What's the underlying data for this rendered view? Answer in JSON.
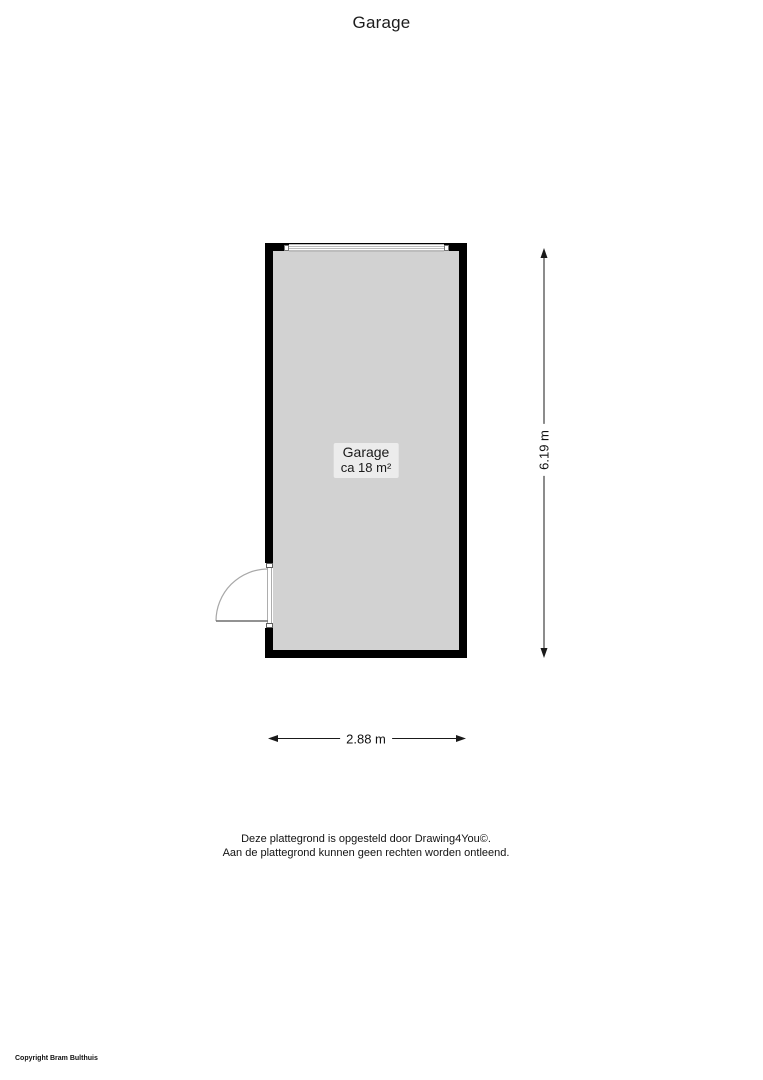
{
  "page": {
    "title": "Garage"
  },
  "plan": {
    "room": {
      "name": "Garage",
      "area": "ca 18 m²"
    },
    "dimensions": {
      "width": "2.88 m",
      "height": "6.19 m"
    },
    "features": {
      "garage_door": "garage-door-top-wall",
      "entry_door": "hinged-door-left-wall"
    },
    "colors": {
      "wall": "#000000",
      "floor": "#d2d2d2",
      "label_background": "#ececec",
      "dimension_line": "#1a1a1a",
      "door_arc": "#a8a8a8"
    }
  },
  "footer": {
    "line1": "Deze plattegrond is opgesteld door Drawing4You©.",
    "line2": "Aan de plattegrond kunnen geen rechten worden ontleend."
  },
  "copyright": "Copyright Bram Bulthuis"
}
